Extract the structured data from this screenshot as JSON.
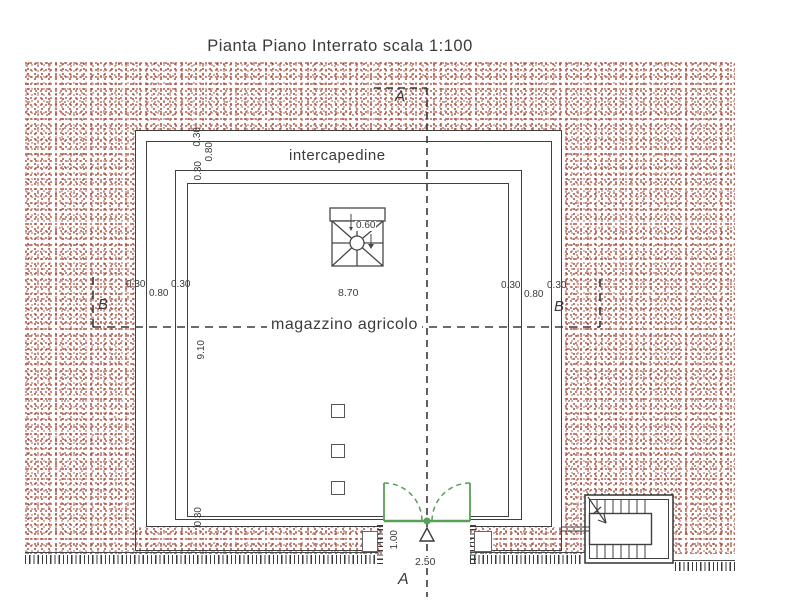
{
  "drawing": {
    "title": "Pianta Piano Interrato scala 1:100",
    "room_label": "magazzino agricolo",
    "cavity_label": "intercapedine",
    "section_marker_a": "A",
    "section_marker_b": "B",
    "dims": {
      "wall_outer": "0.30",
      "cavity_gap": "0.80",
      "wall_inner": "0.30",
      "room_width": "8.70",
      "room_depth": "9.10",
      "wall_bottom": "0.30",
      "stair_well": "0.60",
      "door_depth": "1.00",
      "door_width": "2.50"
    },
    "colors": {
      "earth_stipple": "#b4604f",
      "door_green": "#55a155",
      "line": "#3f3f3f"
    }
  }
}
